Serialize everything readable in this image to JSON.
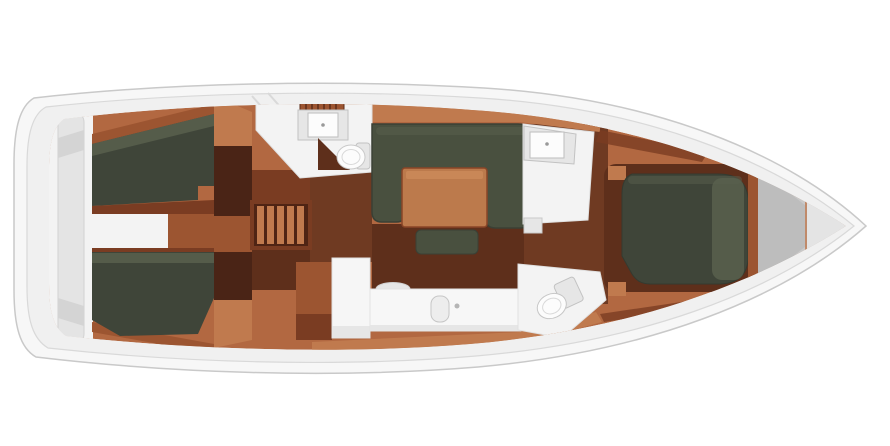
{
  "canvas": {
    "width": 890,
    "height": 446
  },
  "scene": {
    "type": "yacht-floor-plan",
    "view": "top-down",
    "bow_direction": "right",
    "description": "Top-down interior layout plan of a sailing yacht: rounded stern transom at left, pointed bow at right, two aft double cabins with dark berths, companionway steps, aft head with sink and toilet, saloon with U-shaped settee, wooden table and bench, galley with fridge, counter and sink, forward head with sink, forward shower room with toilet, and forward owner's cabin with island double berth ahead of a grey anchor-locker bow section."
  },
  "regions": [
    {
      "id": "transom",
      "label": "stern transom platform"
    },
    {
      "id": "aft-cabin-starboard",
      "label": "aft double cabin (upper)"
    },
    {
      "id": "aft-cabin-port",
      "label": "aft double cabin (lower)"
    },
    {
      "id": "companionway",
      "label": "companionway steps"
    },
    {
      "id": "aft-head",
      "label": "aft head (sink, toilet, vanity)"
    },
    {
      "id": "saloon",
      "label": "saloon (U-settee, table, bench)"
    },
    {
      "id": "galley",
      "label": "galley (fridge, counter, sink)"
    },
    {
      "id": "forward-head",
      "label": "forward head (sink)"
    },
    {
      "id": "forward-shower",
      "label": "forward shower room (toilet)"
    },
    {
      "id": "forward-cabin",
      "label": "forward cabin with island berth"
    },
    {
      "id": "bow-locker",
      "label": "bow anchor locker"
    }
  ],
  "palette": {
    "page_bg": "#ffffff",
    "hull_fill": "#f7f7f7",
    "hull_stroke": "#c9c9c9",
    "deck_fill": "#f0f0f0",
    "deck_stroke": "#d9d9d9",
    "interior_wood": "#b26841",
    "wood_light": "#c07a4e",
    "wood_mid": "#9c5531",
    "wood_dark": "#7a3c22",
    "floor_dark": "#6f3a22",
    "floor_darker": "#5e2f1b",
    "bulkhead": "#4a2416",
    "berth": "#3f4539",
    "berth_light": "#59604e",
    "settee": "#49503f",
    "settee_outline": "#3a4035",
    "table_wood": "#bc7a4c",
    "table_edge": "#8a4527",
    "white_room": "#f3f3f3",
    "room_stroke": "#e0e0e0",
    "fixture_fill": "#fcfcfc",
    "fixture_grey": "#e6e6e6",
    "fixture_stroke": "#c2c2c2",
    "counter_white": "#f7f7f7",
    "transom_band": "#e4e4e4",
    "bow_metal": "#c9c9c9",
    "bow_metal_dark": "#bdbdbd",
    "bow_metal_light": "#e4e4e4",
    "copper_trim": "#c08a6a"
  }
}
